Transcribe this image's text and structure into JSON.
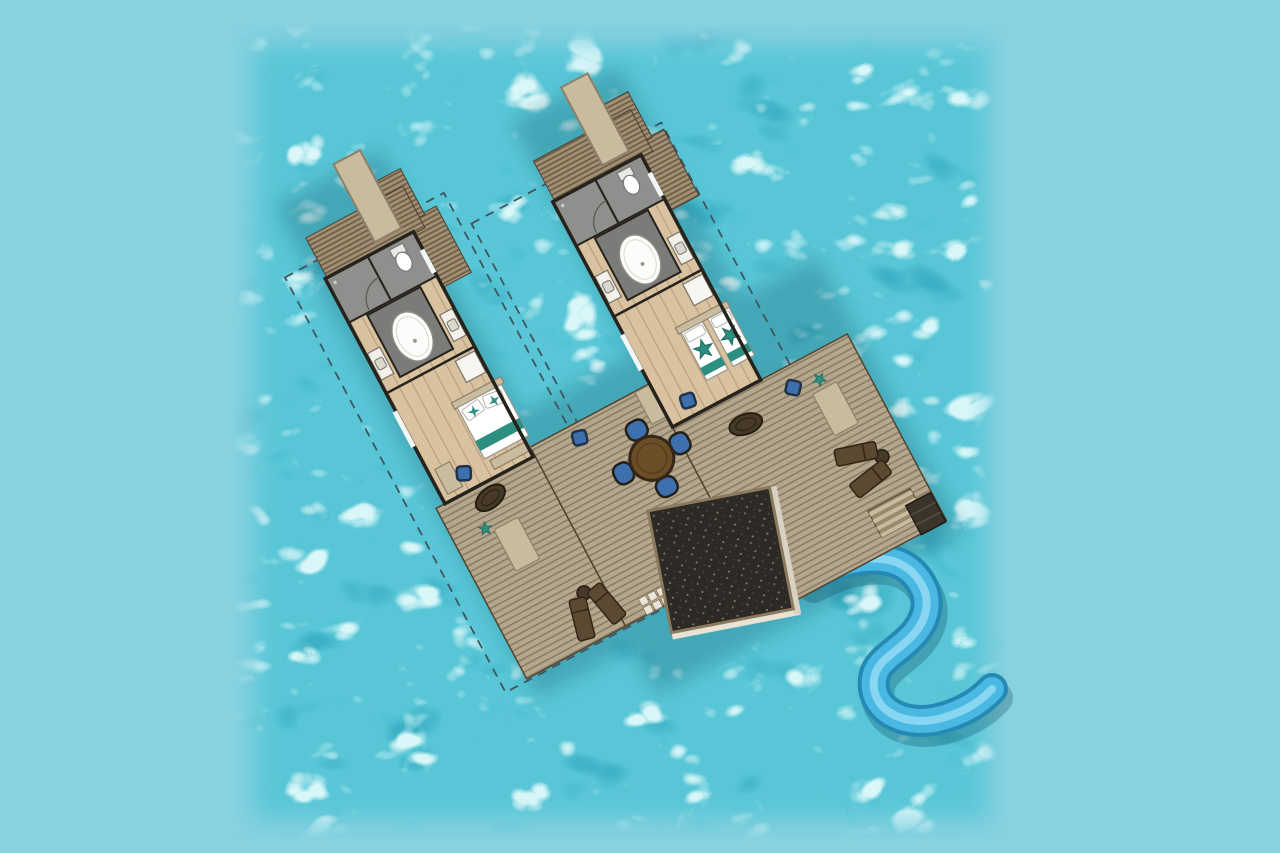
{
  "image": {
    "description": "Top-down architectural floor plan of two overwater villas joined by a shared timber sun deck with a dark plunge pool, round dining table with four blue chairs, sun loungers, daybeds and a curved blue water slide, all surrounded by turquoise sea water",
    "width_px": 1280,
    "height_px": 853
  },
  "palette": {
    "background": "#87d2e1",
    "water_base": "#58c6d6",
    "water_light": "#d9f7f9",
    "water_shadow": "#2aa3ba",
    "deck": "#b5a78e",
    "deck_stripe": "#8d7d64",
    "roof": "#a08f72",
    "roof_stripe": "#6a5a44",
    "wood_floor": "#d9c29f",
    "wood_line": "#bb9f7a",
    "bathroom_floor": "#8f8f8d",
    "bathroom_platform": "#7b7b79",
    "jetty": "#c9bb9e",
    "wall": "#26231c",
    "teal": "#2c8f7f",
    "cushion_blue": "#3e6fae",
    "cushion_edge": "#1f3448",
    "table_brown": "#6b4e26",
    "lounger_brown": "#5b4a31",
    "pool_dark": "#2d2a26",
    "pool_border": "#8a7a5e",
    "slide_blue": "#49b9e3",
    "slide_dark": "#2589b4",
    "slide_light": "#8fd9f2",
    "dashed_line": "#3f5560"
  },
  "plan": {
    "rotation_deg": -28,
    "villa_1": {
      "label": "villa-1",
      "bed_type": "king bed",
      "features": [
        "entry jetty",
        "covered entry walkway",
        "bathroom with oval bathtub",
        "toilet room",
        "two vanities with sinks",
        "wardrobe",
        "king bed with teal runner and two starfish pillows",
        "foot bench",
        "side bench",
        "blue floor cushion"
      ]
    },
    "villa_2": {
      "label": "villa-2",
      "bed_type": "twin beds",
      "features": [
        "entry jetty",
        "covered entry walkway",
        "bathroom with oval bathtub",
        "toilet room",
        "two vanities with sinks",
        "wardrobe",
        "two single beds with teal runners and starfish throws",
        "blue floor cushion"
      ]
    },
    "shared_deck": {
      "features": [
        "round dining table",
        "4 blue dining chairs",
        "pair of sun loungers with side table (lower deck)",
        "pair of sun loungers with side table (right deck)",
        "dark plunge pool with pale coping",
        "curved blue water slide into sea",
        "sea-access step grid",
        "stair strip to water",
        "dark swim platform",
        "2 tan daybeds",
        "2 hanging chairs",
        "2 blue deck cushions",
        "2 teal starfish ornaments",
        "dashed plot boundary around each villa"
      ]
    }
  }
}
